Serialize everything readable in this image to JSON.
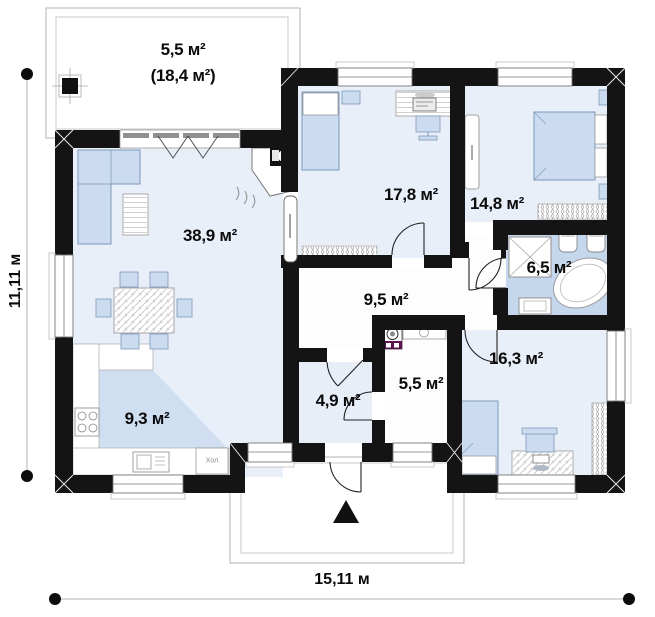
{
  "plan": {
    "dimensions": {
      "width": "15,11 м",
      "height": "11,11 м"
    },
    "rooms": {
      "terrace": {
        "area": "5,5 м²",
        "area_total": "(18,4 м²)"
      },
      "living": {
        "area": "38,9 м²"
      },
      "office": {
        "area": "17,8 м²"
      },
      "bedroom": {
        "area": "14,8 м²"
      },
      "bath": {
        "area": "6,5 м²"
      },
      "hall": {
        "area": "9,5 м²"
      },
      "teen_room": {
        "area": "16,3 м²"
      },
      "utility": {
        "area": "5,5 м²"
      },
      "vestibule": {
        "area": "4,9 м²"
      },
      "kitchen": {
        "area": "9,3 м²"
      }
    },
    "annotations": {
      "fridge": "Хол"
    },
    "colors": {
      "wall": "#141414",
      "room_floor": "#e9eff9",
      "bath_floor": "#c5d7ec",
      "furniture": "#ccdcf0",
      "kitchen_zone": "#cfdef1",
      "washer_accent": "#5a1550",
      "dim_line": "#d9d9d9"
    }
  }
}
